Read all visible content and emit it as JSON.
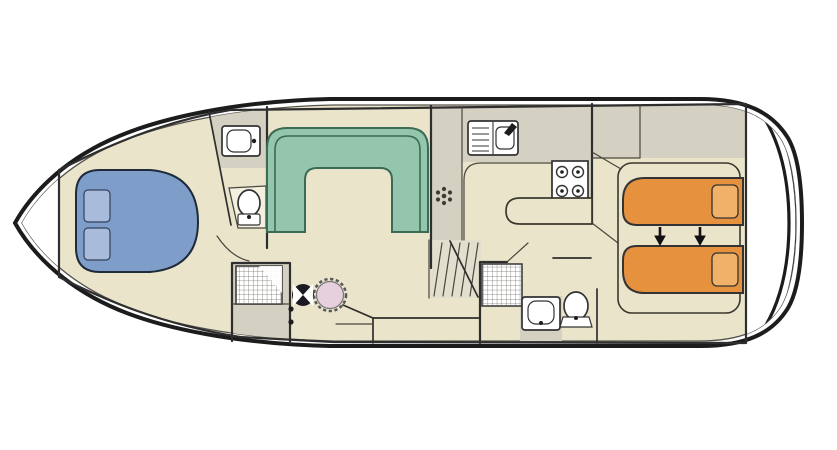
{
  "diagram": {
    "type": "houseboat-deck-plan",
    "orientation": "bow-left",
    "colors": {
      "background": "#ffffff",
      "hull_outline": "#1c1c1c",
      "deck": "#eae4cb",
      "zone_gray": "#d5d1c2",
      "wall": "#2e2e2e",
      "bench_green": "#93c6ad",
      "bench_border": "#3a6b54",
      "bed_blue": "#7e9ec9",
      "pillow_blue": "#a9bbdb",
      "bed_orange": "#e5913e",
      "pillow_orange": "#f2b169",
      "wheel_pink": "#e6d0dd",
      "fixture_white": "#ffffff"
    },
    "areas": [
      {
        "name": "bow-deck",
        "furniture": [
          "anchor-locker"
        ]
      },
      {
        "name": "bow-cabin",
        "furniture": [
          "double-bed",
          "pillow",
          "pillow"
        ]
      },
      {
        "name": "forward-bathroom",
        "furniture": [
          "washbasin",
          "toilet",
          "shower-tray",
          "door-arc"
        ]
      },
      {
        "name": "saloon",
        "furniture": [
          "u-shaped-dinette-bench",
          "table-pedestal"
        ]
      },
      {
        "name": "helm-station",
        "furniture": [
          "steering-wheel",
          "helm-seat",
          "side-door-handles"
        ]
      },
      {
        "name": "galley",
        "furniture": [
          "sink-with-drainer",
          "four-burner-stove",
          "worktop",
          "counter-extension"
        ]
      },
      {
        "name": "companionway",
        "furniture": [
          "steps"
        ]
      },
      {
        "name": "aft-bathroom",
        "furniture": [
          "shower-tray",
          "washbasin",
          "toilet"
        ]
      },
      {
        "name": "aft-cabin",
        "furniture": [
          "wardrobe",
          "single-bed",
          "single-bed",
          "pillow",
          "pillow",
          "bed-join-arrows"
        ]
      },
      {
        "name": "aft-deck",
        "furniture": [
          "transom-rails"
        ]
      }
    ],
    "berths": {
      "double_beds": 1,
      "single_beds": 2
    },
    "stove_burners": 4,
    "bed_join_arrows": 2
  }
}
